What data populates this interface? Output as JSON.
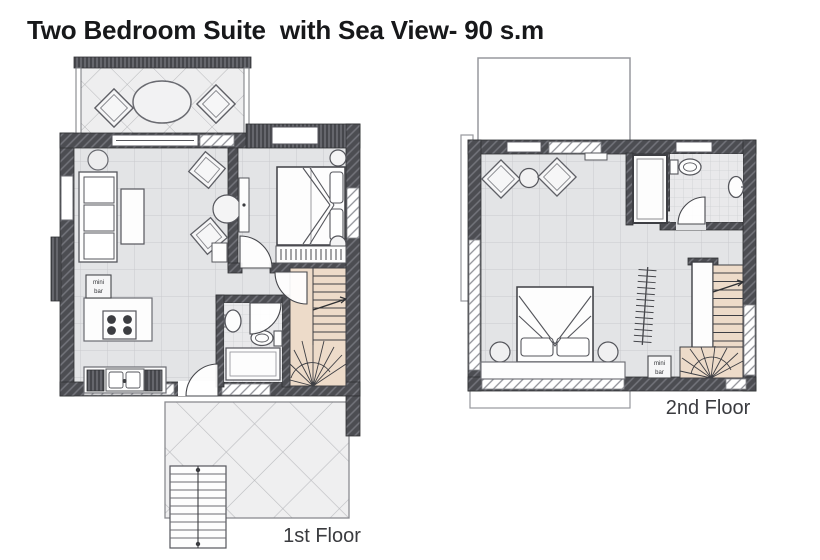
{
  "title": "Two Bedroom Suite  with Sea View- 90 s.m",
  "floors": {
    "first": {
      "label": "1st Floor",
      "minibar": {
        "line1": "mini",
        "line2": "bar"
      }
    },
    "second": {
      "label": "2nd Floor",
      "minibar": {
        "line1": "mini",
        "line2": "bar"
      }
    }
  },
  "colors": {
    "wall_dark": "#4c4d52",
    "wall_hatch_light": "#8f9097",
    "floor_fill": "#e3e4e6",
    "terrace_fill": "#efeff0",
    "stair_fill": "#eddbc9",
    "furniture_stroke": "#55565c",
    "title_text": "#17181a",
    "label_text": "#3a3b3f"
  }
}
